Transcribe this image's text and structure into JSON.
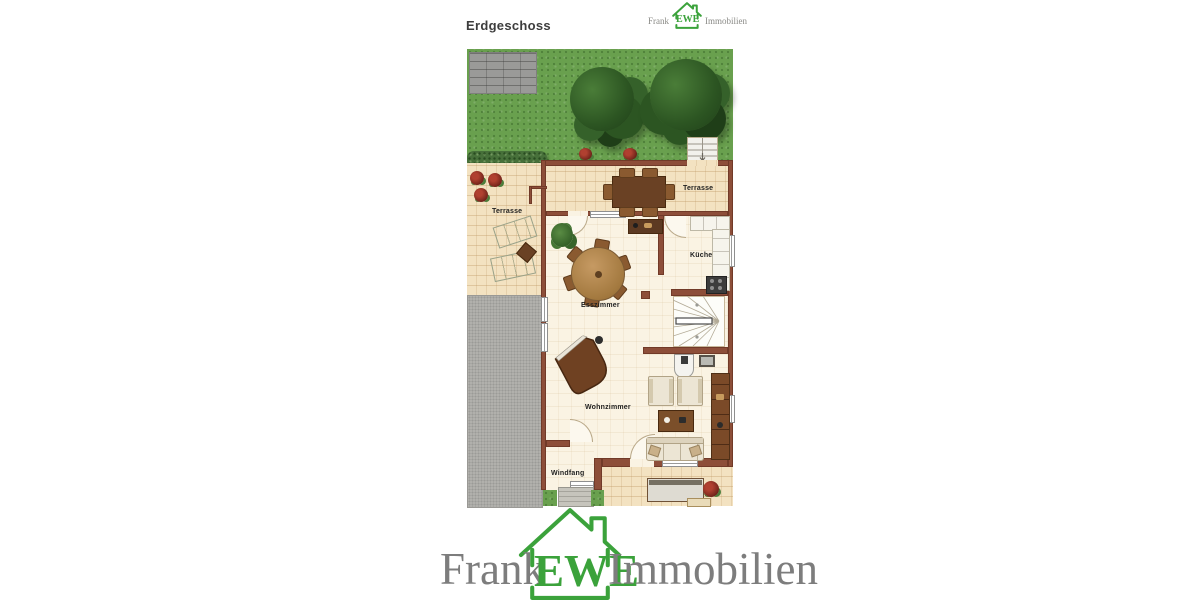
{
  "header": {
    "title": "Erdgeschoss"
  },
  "brand": {
    "left": "Frank",
    "middle": "EWE",
    "right": "Immobilien"
  },
  "floorplan": {
    "labels": {
      "terrace_upper": "Terrasse",
      "terrace_left": "Terrasse",
      "kitchen": "Küche",
      "dining": "Esszimmer",
      "living": "Wohnzimmer",
      "vestibule": "Windfang"
    },
    "colors": {
      "brand_green": "#3ba23b",
      "brand_gray": "#7d7d7d",
      "wall": "#8d4e39",
      "grass": "#69a04e",
      "terrace_tile": "#f3e2c1",
      "interior_floor": "#faf3e3",
      "paving": "#b2b1ad"
    }
  }
}
